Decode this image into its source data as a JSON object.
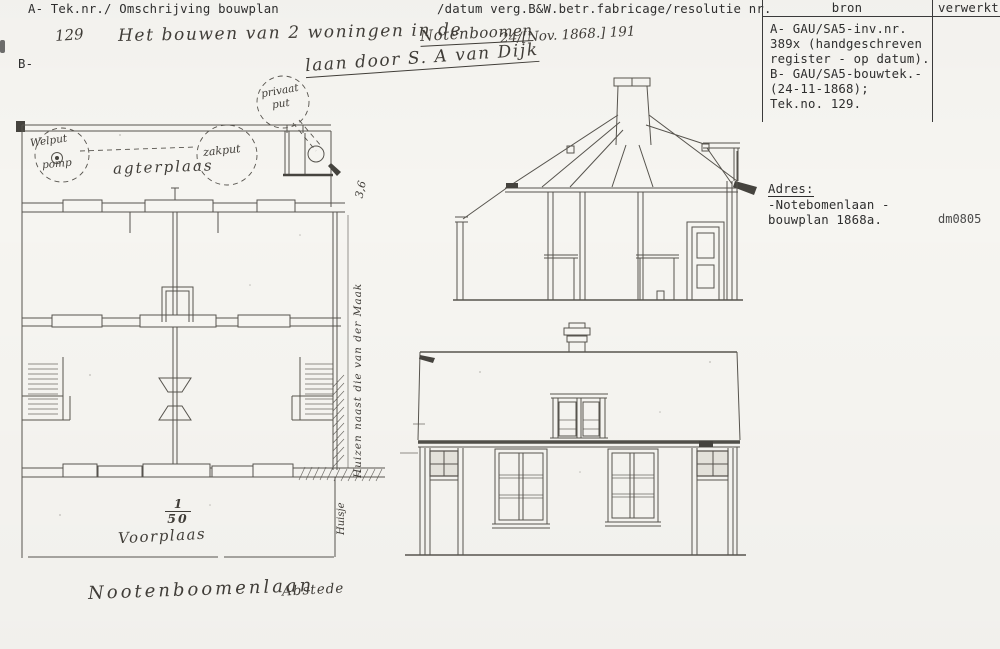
{
  "colors": {
    "paper": "#f6f5f1",
    "ink_typed": "#2e2e2e",
    "ink_drawing": "#57544e",
    "ink_hand": "#403d38"
  },
  "header": {
    "field_a": "A- Tek.nr./ Omschrijving bouwplan",
    "field_b": "B-",
    "datum_field": "/datum verg.B&W.betr.fabricage/resolutie nr."
  },
  "handwriting": {
    "tek_nr": "129",
    "description": "Het bouwen van 2 woningen in de",
    "street_name": "Notenboomen",
    "date_annotation": "24/[Nov. 1868.] 191",
    "description_line2": "laan door S. A van Dijk"
  },
  "bron_table": {
    "header_bron": "bron",
    "header_verwerkt": "verwerkt",
    "lines": [
      "A- GAU/SA5-inv.nr.",
      "389x (handgeschreven",
      "register - op datum).",
      "B- GAU/SA5-bouwtek.-",
      "(24-11-1868);",
      "Tek.no. 129."
    ]
  },
  "adres_block": {
    "label": "Adres:",
    "line1": "-Notebomenlaan -",
    "line2": "bouwplan 1868a.",
    "code": "dm0805"
  },
  "floor_plan": {
    "agterplaas": "agterplaas",
    "welput_line1": "Welput",
    "welput_line2": "pomp",
    "zakput": "zakput",
    "privaat_line1": "privaat",
    "privaat_line2": "put",
    "dim_right": "3,6",
    "side_note_vertical": "Huizen naast die van der Maak",
    "side_note_lower": "Huisje",
    "scale_num": "1",
    "scale_den": "50",
    "voorplaas": "Voorplaas"
  },
  "footer": {
    "street": "Nootenboomenlaan",
    "district": "Abstede"
  }
}
